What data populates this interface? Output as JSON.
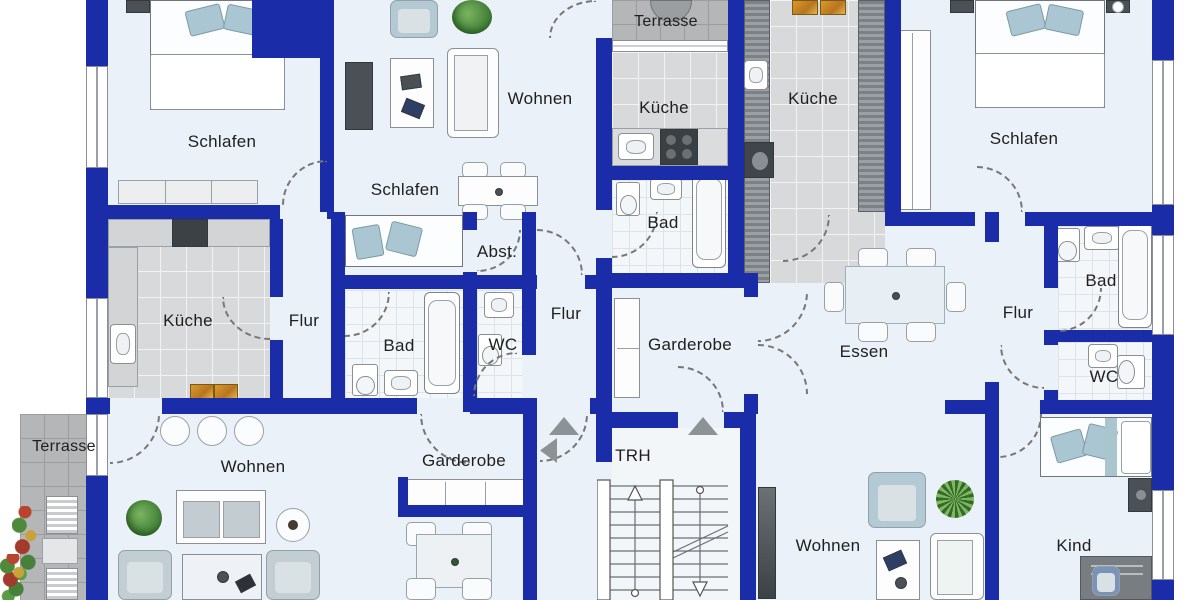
{
  "palette": {
    "wall": "#1b2ca8",
    "room_floor": "#ebf1f8",
    "terrace_tile": "#b5b6b8",
    "kitchen_floor": "#d8d9da",
    "bath_floor": "#f4f7fa",
    "furniture_accent_blue": "#a9c6d2",
    "furniture_dark": "#4a5056",
    "plant_green": "#3f7d37",
    "label_color": "#1f1f1f",
    "door_arc": "#777777",
    "entry_arrow": "#8d9296"
  },
  "labels": {
    "schlafen_top_left": "Schlafen",
    "wohnen_top": "Wohnen",
    "terrasse_top": "Terrasse",
    "kueche_top_center": "Küche",
    "kueche_top_right": "Küche",
    "schlafen_top_right": "Schlafen",
    "schlafen_middle": "Schlafen",
    "abstellraum": "Abst.",
    "bad_top": "Bad",
    "kueche_left": "Küche",
    "flur_left": "Flur",
    "bad_middle": "Bad",
    "wc_middle": "WC",
    "flur_center": "Flur",
    "garderobe_upper": "Garderobe",
    "essen": "Essen",
    "flur_right": "Flur",
    "bad_right": "Bad",
    "wc_right": "WC",
    "terrasse_bottom_left": "Terrasse",
    "wohnen_bottom_left": "Wohnen",
    "garderobe_lower": "Garderobe",
    "treppenhaus": "TRH",
    "wohnen_bottom_right": "Wohnen",
    "kind": "Kind"
  }
}
